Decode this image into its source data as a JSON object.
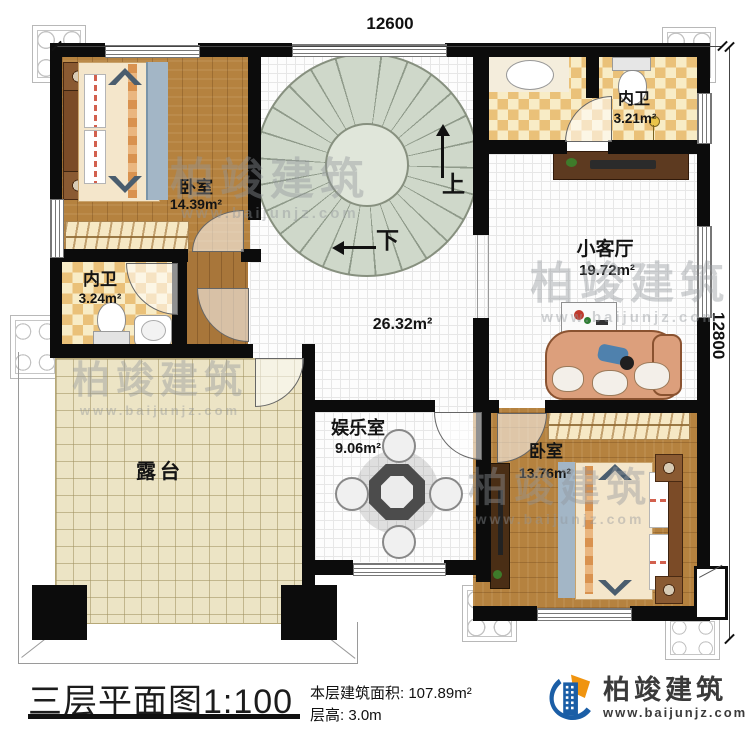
{
  "dimensions": {
    "top": "12600",
    "right": "12800"
  },
  "rooms": {
    "bedroom_top": {
      "name": "卧室",
      "area": "14.39m²"
    },
    "bath_top": {
      "name": "内卫",
      "area": "3.21m²"
    },
    "bath_left": {
      "name": "内卫",
      "area": "3.24m²"
    },
    "living_small": {
      "name": "小客厅",
      "area": "19.72m²"
    },
    "hall": {
      "area": "26.32m²"
    },
    "entertainment": {
      "name": "娱乐室",
      "area": "9.06m²"
    },
    "bedroom_bottom": {
      "name": "卧室",
      "area": "13.76m²"
    },
    "terrace": {
      "name": "露台"
    }
  },
  "stairs": {
    "up_label": "上",
    "down_label": "下"
  },
  "footer": {
    "plan_name": "三层平面图",
    "plan_scale": "1:100",
    "floor_area": "本层建筑面积: 107.89m²",
    "floor_height": "层高: 3.0m"
  },
  "brand": {
    "name": "柏竣建筑",
    "website": "www.baijunjz.com",
    "blue": "#1b5ea6",
    "orange": "#f0940f"
  },
  "watermark": {
    "text": "柏竣建筑",
    "website": "www.baijunjz.com"
  }
}
